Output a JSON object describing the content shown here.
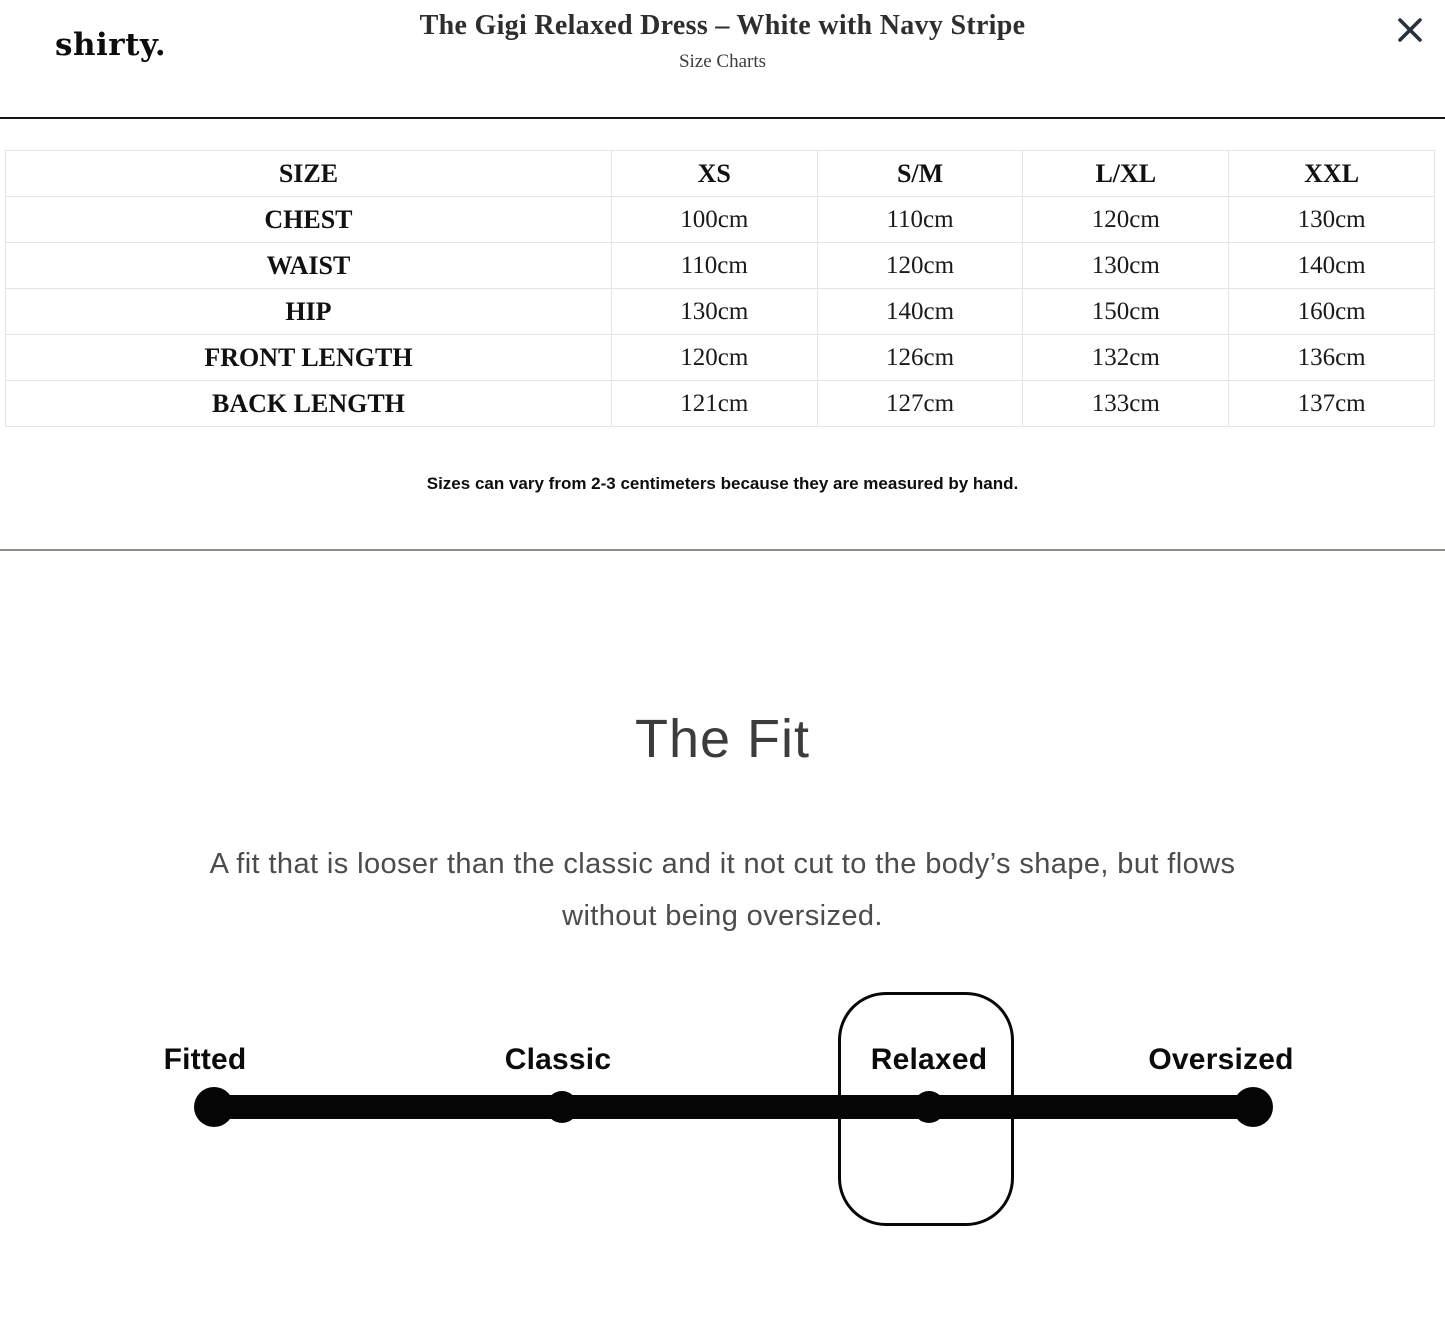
{
  "header": {
    "logo": "shirty.",
    "title": "The Gigi Relaxed Dress – White with Navy Stripe",
    "subtitle": "Size Charts"
  },
  "size_table": {
    "columns": [
      "SIZE",
      "XS",
      "S/M",
      "L/XL",
      "XXL"
    ],
    "rows": [
      {
        "label": "CHEST",
        "values": [
          "100cm",
          "110cm",
          "120cm",
          "130cm"
        ]
      },
      {
        "label": "WAIST",
        "values": [
          "110cm",
          "120cm",
          "130cm",
          "140cm"
        ]
      },
      {
        "label": "HIP",
        "values": [
          "130cm",
          "140cm",
          "150cm",
          "160cm"
        ]
      },
      {
        "label": "FRONT LENGTH",
        "values": [
          "120cm",
          "126cm",
          "132cm",
          "136cm"
        ]
      },
      {
        "label": "BACK LENGTH",
        "values": [
          "121cm",
          "127cm",
          "133cm",
          "137cm"
        ]
      }
    ],
    "note": "Sizes can vary from 2-3 centimeters because they are measured by hand."
  },
  "fit_section": {
    "title": "The Fit",
    "description_line1": "A fit that is looser than the classic and it not cut to the body’s shape, but flows",
    "description_line2": "without being oversized.",
    "scale": {
      "options": [
        "Fitted",
        "Classic",
        "Relaxed",
        "Oversized"
      ],
      "selected": "Relaxed"
    }
  },
  "colors": {
    "close_icon": "#29323c",
    "divider_dark": "#161616",
    "divider_gray": "#8d8d85",
    "table_border": "#e4e4e4",
    "scale_black": "#050505"
  }
}
